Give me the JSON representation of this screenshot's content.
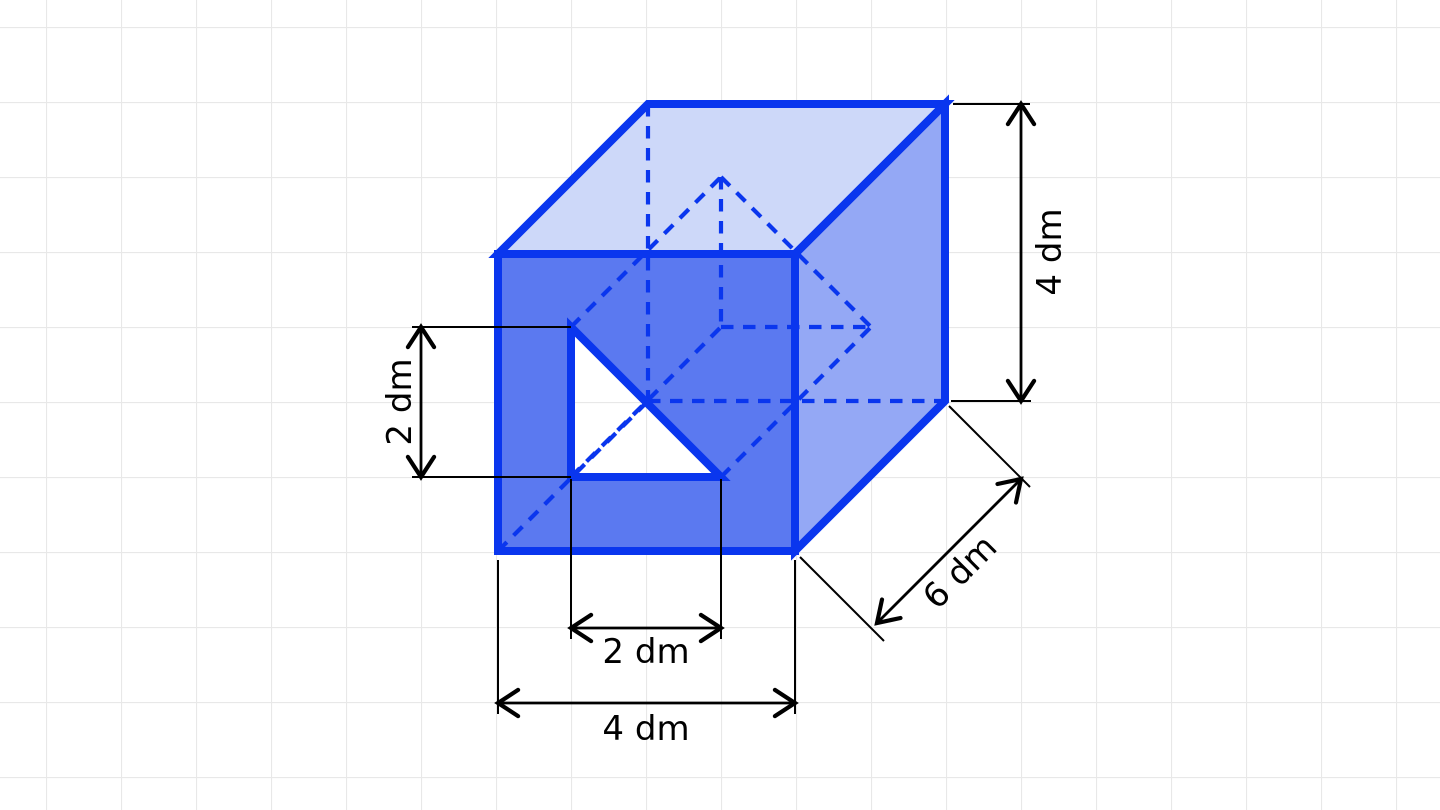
{
  "figure": {
    "kind": "solid-geometry-diagram",
    "description": "Blue cuboid with a triangular prism hole cut through the front face, drawn on light grid paper with black dimension arrows",
    "labels": {
      "height": "4 dm",
      "depth": "6 dm",
      "hole_height": "2 dm",
      "hole_width": "2 dm",
      "width": "4 dm"
    },
    "colors": {
      "background": "#ffffff",
      "grid": "#e8e8e8",
      "outline": "#0a36ee",
      "face_top": "#cdd8f9",
      "face_right": "#94a8f5",
      "face_front": "#5b79f0",
      "hole": "#ffffff",
      "dimension": "#000000"
    }
  }
}
